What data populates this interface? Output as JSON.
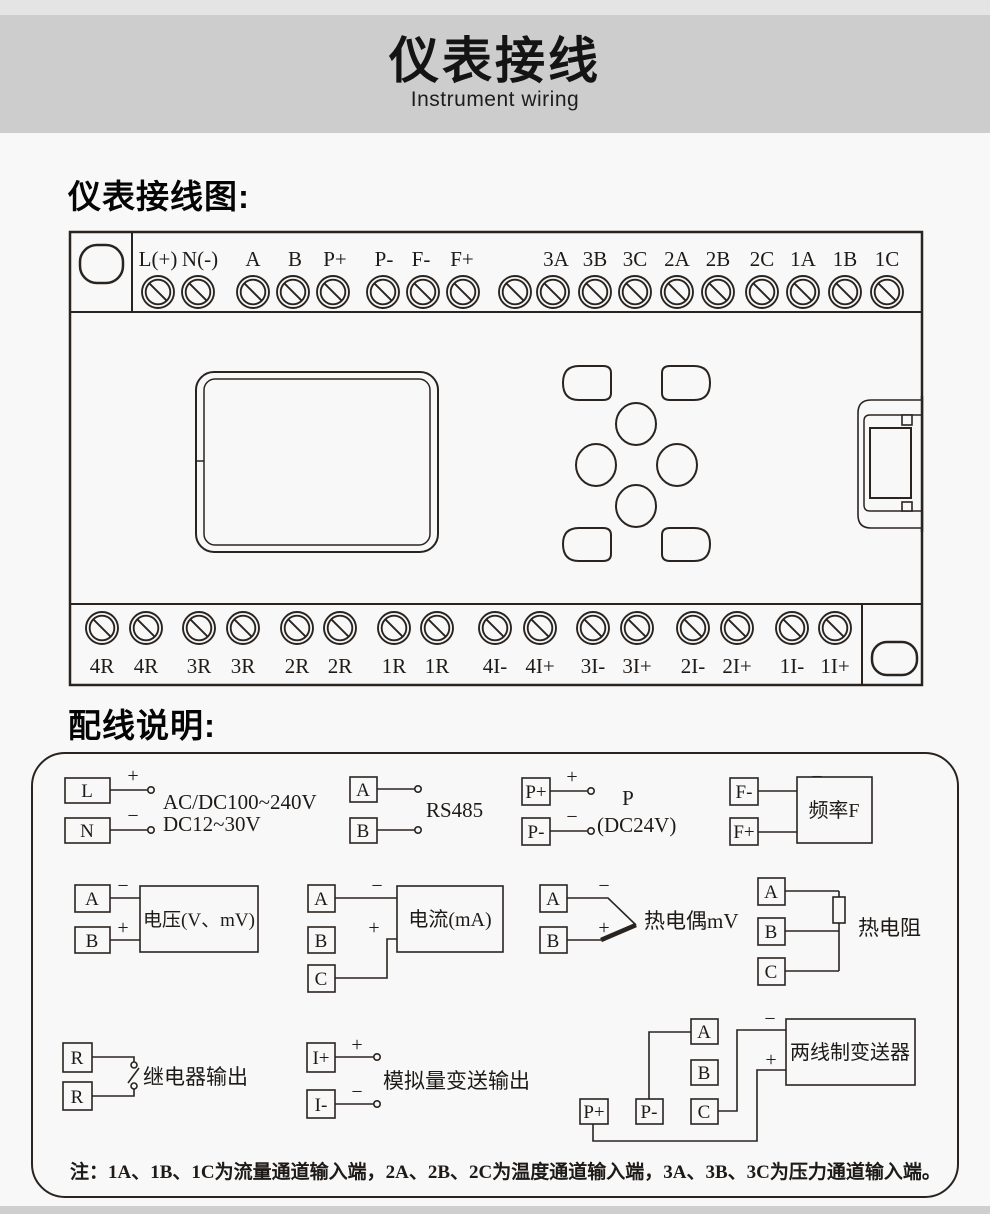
{
  "header": {
    "title": "仪表接线",
    "subtitle": "Instrument wiring"
  },
  "sections": {
    "diagram_heading": "仪表接线图:",
    "wiring_heading": "配线说明:"
  },
  "terminal_diagram": {
    "top_terminals": [
      "L(+)",
      "N(-)",
      "A",
      "B",
      "P+",
      "P-",
      "F-",
      "F+",
      "3A",
      "3B",
      "3C",
      "2A",
      "2B",
      "2C",
      "1A",
      "1B",
      "1C"
    ],
    "bottom_terminals": [
      "4R",
      "4R",
      "3R",
      "3R",
      "2R",
      "2R",
      "1R",
      "1R",
      "4I-",
      "4I+",
      "3I-",
      "3I+",
      "2I-",
      "2I+",
      "1I-",
      "1I+"
    ]
  },
  "wiring_notes": {
    "power": {
      "l": "L",
      "n": "N",
      "plus": "+",
      "minus": "−",
      "line1": "AC/DC100~240V",
      "line2": "DC12~30V"
    },
    "rs485": {
      "a": "A",
      "b": "B",
      "label": "RS485"
    },
    "dc24": {
      "pplus": "P+",
      "pminus": "P-",
      "plus": "+",
      "minus": "−",
      "name": "P",
      "detail": "(DC24V)"
    },
    "frequency": {
      "fminus": "F-",
      "fplus": "F+",
      "plus": "+",
      "minus": "−",
      "label": "频率F"
    },
    "voltage": {
      "a": "A",
      "b": "B",
      "plus": "+",
      "minus": "−",
      "label": "电压(V、mV)"
    },
    "current": {
      "a": "A",
      "b": "B",
      "c": "C",
      "plus": "+",
      "minus": "−",
      "label": "电流(mA)"
    },
    "thermocouple": {
      "a": "A",
      "b": "B",
      "plus": "+",
      "minus": "−",
      "label": "热电偶mV"
    },
    "rtd": {
      "a": "A",
      "b": "B",
      "c": "C",
      "label": "热电阻"
    },
    "relay": {
      "r1": "R",
      "r2": "R",
      "label": "继电器输出"
    },
    "analog_out": {
      "iplus": "I+",
      "iminus": "I-",
      "plus": "+",
      "minus": "−",
      "label": "模拟量变送输出"
    },
    "transmitter": {
      "a": "A",
      "b": "B",
      "c": "C",
      "pplus": "P+",
      "pminus": "P-",
      "plus": "+",
      "minus": "−",
      "label": "两线制变送器"
    },
    "note": "注：1A、1B、1C为流量通道输入端，2A、2B、2C为温度通道输入端，3A、3B、3C为压力通道输入端。"
  },
  "colors": {
    "line": "#2a2420",
    "header_band": "#cdcdcd",
    "page_bg": "#f8f8f8"
  }
}
